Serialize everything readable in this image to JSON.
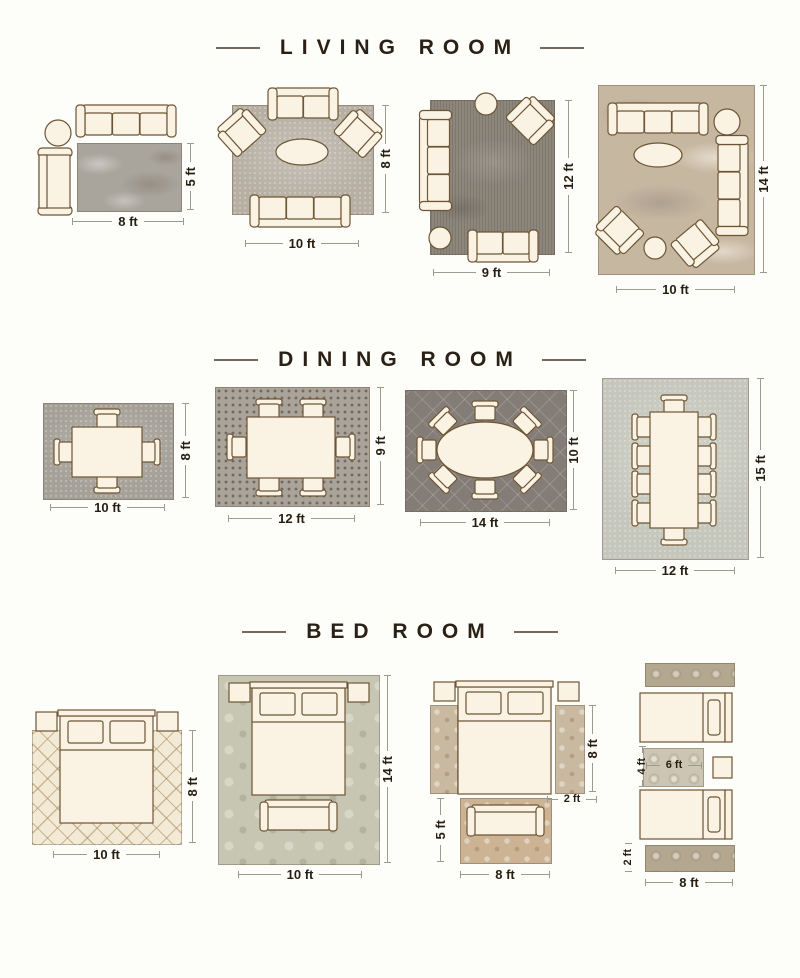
{
  "page": {
    "type": "rug-size-guide-infographic"
  },
  "colors": {
    "title_text": "#2a2015",
    "dim_text": "#261e12",
    "dim_line": "#9b9b93",
    "furniture_fill": "#faf3e3",
    "furniture_stroke": "#6d5535",
    "rugs": {
      "living_8x5": "#a9a59c",
      "living_10x8": "#b7afa3",
      "living_9x12": "#8d867b",
      "living_10x14": "#c6b7a1",
      "dining_10x8": "#a5a198",
      "dining_12x9": "#aaa399",
      "dining_14x10": "#847d77",
      "dining_12x15": "#c6c7bc",
      "bed_10x8": "#f3ead6",
      "bed_10x14": "#c7c6b2",
      "bed_runner_tan": "#c9b9a0",
      "bed_foot_rug": "#cbb394",
      "bed_runner_ornate": "#b3a78f",
      "bed_between_rug": "#ccc5b3"
    }
  },
  "sections": [
    {
      "id": "living-room",
      "title": "LIVING ROOM",
      "layouts": [
        {
          "rug_sizes_ft": [
            "8 x 5"
          ],
          "width_label": "8 ft",
          "height_label": "5 ft",
          "furniture": [
            "sofa",
            "round-side-table",
            "chaise"
          ]
        },
        {
          "rug_sizes_ft": [
            "10 x 8"
          ],
          "width_label": "10 ft",
          "height_label": "8 ft",
          "furniture": [
            "sofa",
            "armchair",
            "armchair",
            "oval-coffee-table",
            "sofa"
          ]
        },
        {
          "rug_sizes_ft": [
            "9 x 12"
          ],
          "width_label": "9 ft",
          "height_label": "12 ft",
          "furniture": [
            "sofa",
            "armchair",
            "round-side-table",
            "round-side-table",
            "loveseat"
          ]
        },
        {
          "rug_sizes_ft": [
            "10 x 14"
          ],
          "width_label": "10 ft",
          "height_label": "14 ft",
          "furniture": [
            "sofa",
            "sofa",
            "armchair",
            "armchair",
            "oval-coffee-table",
            "round-side-table",
            "round-side-table"
          ]
        }
      ]
    },
    {
      "id": "dining-room",
      "title": "DINING ROOM",
      "layouts": [
        {
          "rug_sizes_ft": [
            "10 x 8"
          ],
          "width_label": "10 ft",
          "height_label": "8 ft",
          "furniture": [
            "dining-table",
            "4 chairs"
          ]
        },
        {
          "rug_sizes_ft": [
            "12 x 9"
          ],
          "width_label": "12 ft",
          "height_label": "9 ft",
          "furniture": [
            "dining-table",
            "6 chairs"
          ]
        },
        {
          "rug_sizes_ft": [
            "14 x 10"
          ],
          "width_label": "14 ft",
          "height_label": "10 ft",
          "furniture": [
            "oval-dining-table",
            "8 chairs"
          ]
        },
        {
          "rug_sizes_ft": [
            "12 x 15"
          ],
          "width_label": "12 ft",
          "height_label": "15 ft",
          "furniture": [
            "dining-table",
            "10 chairs"
          ]
        }
      ]
    },
    {
      "id": "bed-room",
      "title": "BED ROOM",
      "layouts": [
        {
          "rug_sizes_ft": [
            "10 x 8"
          ],
          "width_label": "10 ft",
          "height_label": "8 ft",
          "furniture": [
            "queen-bed",
            "nightstand",
            "nightstand"
          ]
        },
        {
          "rug_sizes_ft": [
            "10 x 14"
          ],
          "width_label": "10 ft",
          "height_label": "14 ft",
          "furniture": [
            "queen-bed",
            "nightstand",
            "nightstand",
            "bench"
          ]
        },
        {
          "rug_sizes_ft": [
            "2 x 8",
            "2 x 8",
            "8 x 5"
          ],
          "runner_length_label": "8 ft",
          "runner_width_label": "2 ft",
          "foot_rug_width_label": "8 ft",
          "foot_rug_height_label": "5 ft",
          "furniture": [
            "queen-bed",
            "nightstand",
            "nightstand",
            "runner-rug",
            "runner-rug",
            "foot-rug",
            "bench"
          ]
        },
        {
          "rug_sizes_ft": [
            "8 x 2",
            "6 x 4",
            "8 x 2"
          ],
          "runner_length_label": "8 ft",
          "runner_width_label": "2 ft",
          "center_rug_width_label": "6 ft",
          "center_rug_height_label": "4 ft",
          "furniture": [
            "twin-bed",
            "twin-bed",
            "nightstand",
            "runner-rug",
            "runner-rug",
            "between-beds-rug"
          ]
        }
      ]
    }
  ]
}
